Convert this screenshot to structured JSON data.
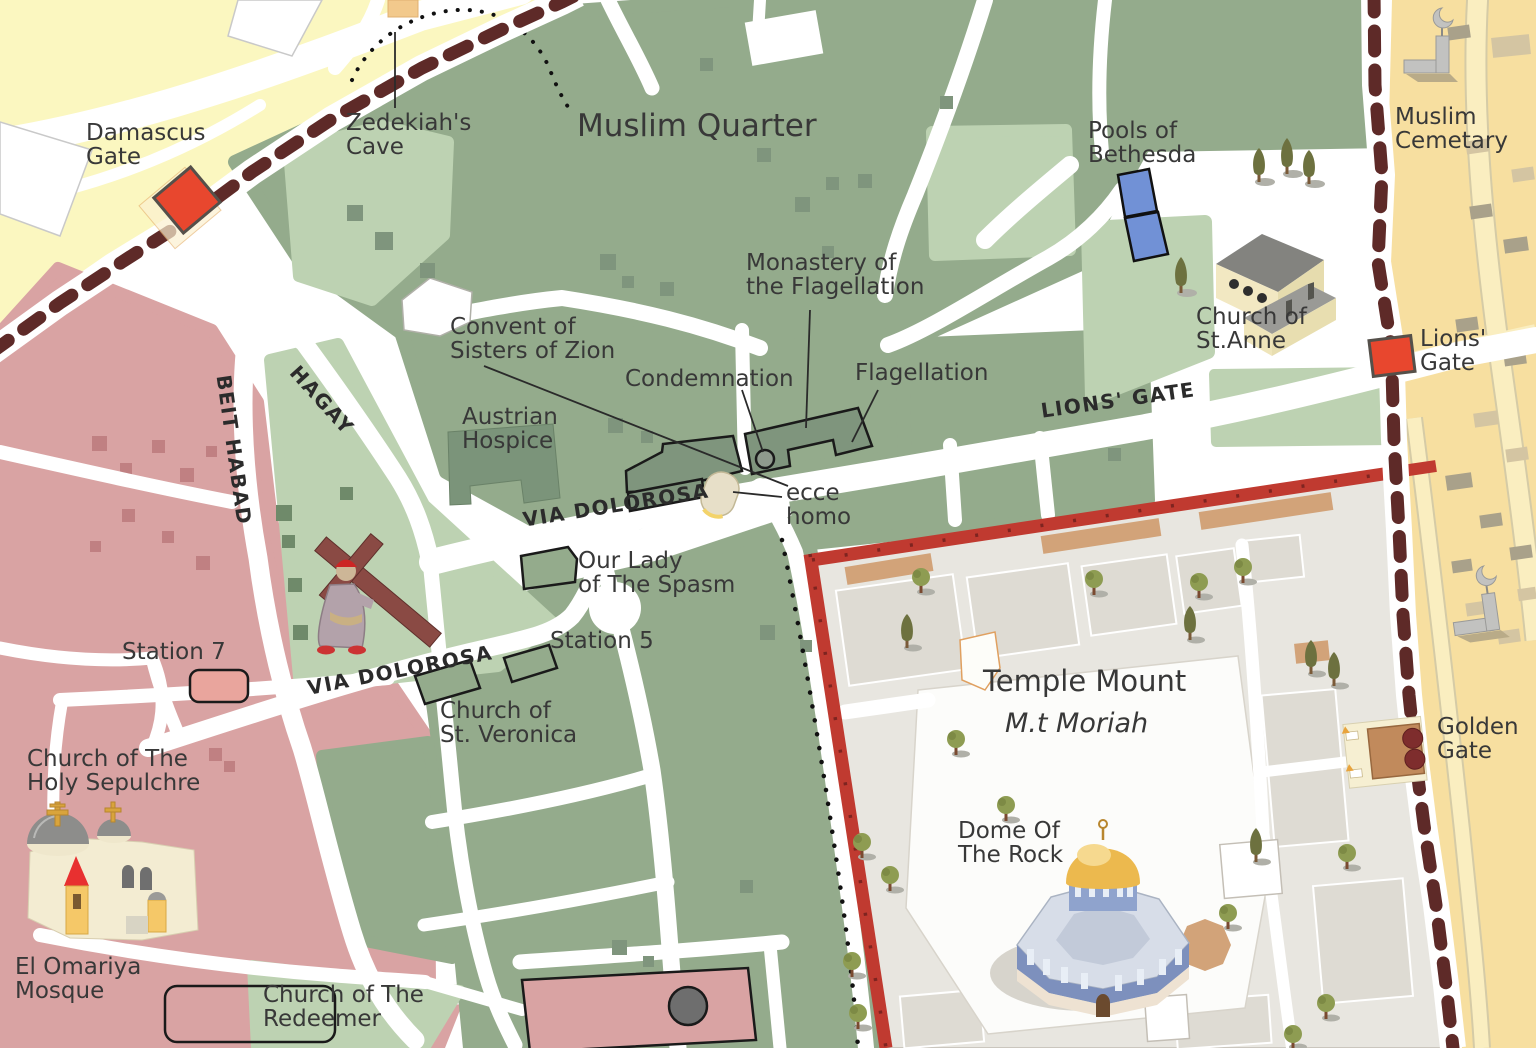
{
  "map": {
    "places": {
      "damascus_gate": "Damascus\nGate",
      "zedekiahs_cave": "Zedekiah's\nCave",
      "muslim_quarter": "Muslim Quarter",
      "pools_of_bethesda": "Pools of\nBethesda",
      "muslim_cemetary": "Muslim\nCemetary",
      "monastery_of_the_flagellation": "Monastery of\nthe Flagellation",
      "convent_of_sisters_of_zion": "Convent of\nSisters of Zion",
      "condemnation": "Condemnation",
      "flagellation": "Flagellation",
      "austrian_hospice": "Austrian\nHospice",
      "lions_gate": "Lions'\nGate",
      "church_of_st_anne": "Church of\nSt.Anne",
      "ecce_homo": "ecce\nhomo",
      "our_lady_of_the_spasm": "Our Lady\nof The Spasm",
      "station_5": "Station 5",
      "station_7": "Station 7",
      "church_of_st_veronica": "Church of\nSt. Veronica",
      "church_of_the_holy_sepulchre": "Church of The\nHoly Sepulchre",
      "el_omariya_mosque": "El Omariya\nMosque",
      "church_of_the_redeemer": "Church of The\nRedeemer",
      "temple_mount": "Temple Mount",
      "mt_moriah": "M.t Moriah",
      "dome_of_the_rock": "Dome Of\nThe Rock",
      "golden_gate": "Golden\nGate"
    },
    "streets": {
      "via_dolorosa": "VIA DOLOROSA",
      "lions_gate_street": "LIONS' GATE",
      "beit_habad": "BEIT HABAD",
      "hagay": "HAGAY"
    },
    "colors": {
      "muslim_quarter_green": "#94ab8c",
      "light_green": "#bdd2b2",
      "christian_quarter_pink": "#d9a3a3",
      "outside_northwest_yellow": "#fbf7c0",
      "cemetery_yellow": "#f7dfa0",
      "temple_mount_gray": "#e8e6e0",
      "city_wall_brown": "#5e2a28",
      "gate_red": "#e8472e",
      "temple_wall_red": "#c03a30",
      "pools_blue": "#7191d6",
      "road_white": "#ffffff"
    }
  }
}
